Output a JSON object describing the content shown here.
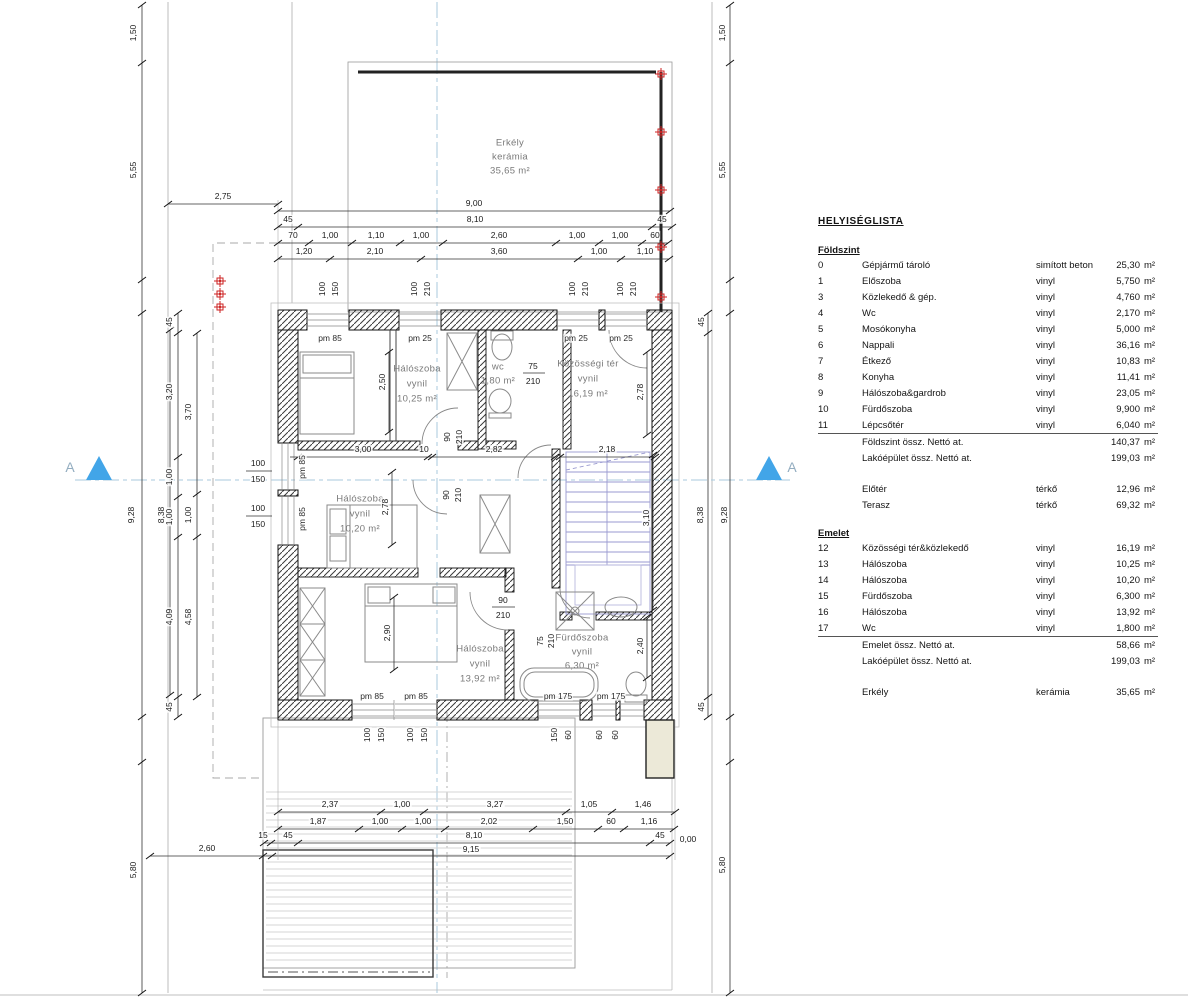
{
  "room_list": {
    "title": "HELYISÉGLISTA",
    "sections": [
      {
        "header": "Földszint",
        "rule": true,
        "rows": [
          {
            "num": "0",
            "name": "Gépjármű tároló",
            "material": "simított beton",
            "area": "25,30",
            "unit": "m²"
          },
          {
            "num": "1",
            "name": "Előszoba",
            "material": "vinyl",
            "area": "5,750",
            "unit": "m²"
          },
          {
            "num": "3",
            "name": "Közlekedő & gép.",
            "material": "vinyl",
            "area": "4,760",
            "unit": "m²"
          },
          {
            "num": "4",
            "name": "Wc",
            "material": "vinyl",
            "area": "2,170",
            "unit": "m²"
          },
          {
            "num": "5",
            "name": "Mosókonyha",
            "material": "vinyl",
            "area": "5,000",
            "unit": "m²"
          },
          {
            "num": "6",
            "name": "Nappali",
            "material": "vinyl",
            "area": "36,16",
            "unit": "m²"
          },
          {
            "num": "7",
            "name": "Étkező",
            "material": "vinyl",
            "area": "10,83",
            "unit": "m²"
          },
          {
            "num": "8",
            "name": "Konyha",
            "material": "vinyl",
            "area": "11,41",
            "unit": "m²"
          },
          {
            "num": "9",
            "name": "Hálószoba&gardrob",
            "material": "vinyl",
            "area": "23,05",
            "unit": "m²"
          },
          {
            "num": "10",
            "name": "Fürdőszoba",
            "material": "vinyl",
            "area": "9,900",
            "unit": "m²"
          },
          {
            "num": "11",
            "name": "Lépcsőtér",
            "material": "vinyl",
            "area": "6,040",
            "unit": "m²"
          }
        ],
        "totals": [
          {
            "name": "Földszint össz. Nettó at.",
            "area": "140,37",
            "unit": "m²"
          },
          {
            "name": "Lakóépület össz. Nettó at.",
            "area": "199,03",
            "unit": "m²"
          }
        ]
      },
      {
        "gap": true,
        "rows": [
          {
            "num": "",
            "name": "Előtér",
            "material": "térkő",
            "area": "12,96",
            "unit": "m²"
          },
          {
            "num": "",
            "name": "Terasz",
            "material": "térkő",
            "area": "69,32",
            "unit": "m²"
          }
        ]
      },
      {
        "header": "Emelet",
        "gap": true,
        "rule": true,
        "rows": [
          {
            "num": "12",
            "name": "Közösségi tér&közlekedő",
            "material": "vinyl",
            "area": "16,19",
            "unit": "m²"
          },
          {
            "num": "13",
            "name": "Hálószoba",
            "material": "vinyl",
            "area": "10,25",
            "unit": "m²"
          },
          {
            "num": "14",
            "name": "Hálószoba",
            "material": "vinyl",
            "area": "10,20",
            "unit": "m²"
          },
          {
            "num": "15",
            "name": "Fürdőszoba",
            "material": "vinyl",
            "area": "6,300",
            "unit": "m²"
          },
          {
            "num": "16",
            "name": "Hálószoba",
            "material": "vinyl",
            "area": "13,92",
            "unit": "m²"
          },
          {
            "num": "17",
            "name": "Wc",
            "material": "vinyl",
            "area": "1,800",
            "unit": "m²"
          }
        ],
        "totals": [
          {
            "name": "Emelet össz. Nettó at.",
            "area": "58,66",
            "unit": "m²"
          },
          {
            "name": "Lakóépület össz. Nettó at.",
            "area": "199,03",
            "unit": "m²"
          }
        ]
      },
      {
        "gap": true,
        "rows": [
          {
            "num": "",
            "name": "Erkély",
            "material": "kerámia",
            "area": "35,65",
            "unit": "m²"
          }
        ]
      }
    ]
  },
  "plan": {
    "room_texts": [
      {
        "t": "Erkély",
        "x": 510,
        "y": 143
      },
      {
        "t": "kerámia",
        "x": 510,
        "y": 157
      },
      {
        "t": "35,65 m²",
        "x": 510,
        "y": 171
      },
      {
        "t": "Hálószoba",
        "x": 417,
        "y": 369
      },
      {
        "t": "vynil",
        "x": 417,
        "y": 384
      },
      {
        "t": "10,25 m²",
        "x": 417,
        "y": 399
      },
      {
        "t": "wc",
        "x": 498,
        "y": 367
      },
      {
        "t": "1,80 m²",
        "x": 498,
        "y": 381
      },
      {
        "t": "Közösségi tér",
        "x": 588,
        "y": 364
      },
      {
        "t": "vynil",
        "x": 588,
        "y": 379
      },
      {
        "t": "16,19 m²",
        "x": 588,
        "y": 394
      },
      {
        "t": "Hálószoba",
        "x": 360,
        "y": 499
      },
      {
        "t": "vynil",
        "x": 360,
        "y": 514
      },
      {
        "t": "10,20 m²",
        "x": 360,
        "y": 529
      },
      {
        "t": "Hálószoba",
        "x": 480,
        "y": 649
      },
      {
        "t": "vynil",
        "x": 480,
        "y": 664
      },
      {
        "t": "13,92 m²",
        "x": 480,
        "y": 679
      },
      {
        "t": "Fürdőszoba",
        "x": 582,
        "y": 638
      },
      {
        "t": "vynil",
        "x": 582,
        "y": 652
      },
      {
        "t": "6,30 m²",
        "x": 582,
        "y": 666
      }
    ],
    "dims": [
      {
        "t": "2,75",
        "x": 223,
        "y": 196
      },
      {
        "t": "9,00",
        "x": 474,
        "y": 203
      },
      {
        "t": "45",
        "x": 288,
        "y": 219
      },
      {
        "t": "8,10",
        "x": 475,
        "y": 219
      },
      {
        "t": "45",
        "x": 662,
        "y": 219
      },
      {
        "t": "70",
        "x": 293,
        "y": 235
      },
      {
        "t": "1,00",
        "x": 330,
        "y": 235
      },
      {
        "t": "1,10",
        "x": 376,
        "y": 235
      },
      {
        "t": "1,00",
        "x": 421,
        "y": 235
      },
      {
        "t": "2,60",
        "x": 499,
        "y": 235
      },
      {
        "t": "1,00",
        "x": 577,
        "y": 235
      },
      {
        "t": "1,00",
        "x": 620,
        "y": 235
      },
      {
        "t": "60",
        "x": 655,
        "y": 235
      },
      {
        "t": "1,20",
        "x": 304,
        "y": 251
      },
      {
        "t": "2,10",
        "x": 375,
        "y": 251
      },
      {
        "t": "3,60",
        "x": 499,
        "y": 251
      },
      {
        "t": "1,00",
        "x": 599,
        "y": 251
      },
      {
        "t": "1,10",
        "x": 645,
        "y": 251
      },
      {
        "t": "3,00",
        "x": 363,
        "y": 449
      },
      {
        "t": "10",
        "x": 424,
        "y": 449
      },
      {
        "t": "2,82",
        "x": 494,
        "y": 449
      },
      {
        "t": "2,18",
        "x": 607,
        "y": 449
      },
      {
        "t": "2,37",
        "x": 330,
        "y": 804
      },
      {
        "t": "1,00",
        "x": 402,
        "y": 804
      },
      {
        "t": "3,27",
        "x": 495,
        "y": 804
      },
      {
        "t": "1,05",
        "x": 589,
        "y": 804
      },
      {
        "t": "1,46",
        "x": 643,
        "y": 804
      },
      {
        "t": "1,87",
        "x": 318,
        "y": 821
      },
      {
        "t": "1,00",
        "x": 380,
        "y": 821
      },
      {
        "t": "1,00",
        "x": 423,
        "y": 821
      },
      {
        "t": "2,02",
        "x": 489,
        "y": 821
      },
      {
        "t": "1,50",
        "x": 565,
        "y": 821
      },
      {
        "t": "60",
        "x": 611,
        "y": 821
      },
      {
        "t": "1,16",
        "x": 649,
        "y": 821
      },
      {
        "t": "15",
        "x": 263,
        "y": 835
      },
      {
        "t": "45",
        "x": 288,
        "y": 835
      },
      {
        "t": "8,10",
        "x": 474,
        "y": 835
      },
      {
        "t": "45",
        "x": 660,
        "y": 835
      },
      {
        "t": "0,00",
        "x": 688,
        "y": 839
      },
      {
        "t": "9,15",
        "x": 471,
        "y": 849
      },
      {
        "t": "2,60",
        "x": 207,
        "y": 848
      },
      {
        "t": "1,50",
        "x": 133,
        "y": 33,
        "r": -90
      },
      {
        "t": "5,55",
        "x": 133,
        "y": 170,
        "r": -90
      },
      {
        "t": "9,28",
        "x": 131,
        "y": 515,
        "r": -90
      },
      {
        "t": "5,80",
        "x": 133,
        "y": 870,
        "r": -90
      },
      {
        "t": "8,38",
        "x": 161,
        "y": 515,
        "r": -90
      },
      {
        "t": "45",
        "x": 169,
        "y": 322,
        "r": -90
      },
      {
        "t": "3,20",
        "x": 169,
        "y": 392,
        "r": -90
      },
      {
        "t": "1,00",
        "x": 169,
        "y": 477,
        "r": -90
      },
      {
        "t": "1,00",
        "x": 169,
        "y": 517,
        "r": -90
      },
      {
        "t": "4,09",
        "x": 169,
        "y": 617,
        "r": -90
      },
      {
        "t": "45",
        "x": 169,
        "y": 707,
        "r": -90
      },
      {
        "t": "3,70",
        "x": 188,
        "y": 412,
        "r": -90
      },
      {
        "t": "1,00",
        "x": 188,
        "y": 515,
        "r": -90
      },
      {
        "t": "4,58",
        "x": 188,
        "y": 617,
        "r": -90
      },
      {
        "t": "1,50",
        "x": 722,
        "y": 33,
        "r": -90
      },
      {
        "t": "5,55",
        "x": 722,
        "y": 170,
        "r": -90
      },
      {
        "t": "9,28",
        "x": 724,
        "y": 515,
        "r": -90
      },
      {
        "t": "5,80",
        "x": 722,
        "y": 865,
        "r": -90
      },
      {
        "t": "45",
        "x": 701,
        "y": 322,
        "r": -90
      },
      {
        "t": "8,38",
        "x": 700,
        "y": 515,
        "r": -90
      },
      {
        "t": "45",
        "x": 701,
        "y": 707,
        "r": -90
      },
      {
        "t": "2,50",
        "x": 382,
        "y": 382,
        "r": -90
      },
      {
        "t": "2,78",
        "x": 640,
        "y": 392,
        "r": -90
      },
      {
        "t": "2,78",
        "x": 385,
        "y": 507,
        "r": -90
      },
      {
        "t": "90",
        "x": 447,
        "y": 437,
        "r": -90
      },
      {
        "t": "210",
        "x": 459,
        "y": 437,
        "r": -90
      },
      {
        "t": "90",
        "x": 446,
        "y": 495,
        "r": -90
      },
      {
        "t": "210",
        "x": 458,
        "y": 495,
        "r": -90
      },
      {
        "t": "75",
        "x": 533,
        "y": 366
      },
      {
        "t": "210",
        "x": 533,
        "y": 381
      },
      {
        "t": "90",
        "x": 503,
        "y": 600
      },
      {
        "t": "210",
        "x": 503,
        "y": 615
      },
      {
        "t": "75",
        "x": 540,
        "y": 641,
        "r": -90
      },
      {
        "t": "210",
        "x": 551,
        "y": 641,
        "r": -90
      },
      {
        "t": "2,90",
        "x": 387,
        "y": 633,
        "r": -90
      },
      {
        "t": "2,40",
        "x": 640,
        "y": 646,
        "r": -90
      },
      {
        "t": "3,10",
        "x": 646,
        "y": 518,
        "r": -90
      }
    ],
    "window_sizes": [
      {
        "t": "100",
        "x": 322,
        "y": 289,
        "r": -90
      },
      {
        "t": "150",
        "x": 335,
        "y": 289,
        "r": -90
      },
      {
        "t": "100",
        "x": 414,
        "y": 289,
        "r": -90
      },
      {
        "t": "210",
        "x": 427,
        "y": 289,
        "r": -90
      },
      {
        "t": "100",
        "x": 572,
        "y": 289,
        "r": -90
      },
      {
        "t": "210",
        "x": 585,
        "y": 289,
        "r": -90
      },
      {
        "t": "100",
        "x": 620,
        "y": 289,
        "r": -90
      },
      {
        "t": "210",
        "x": 633,
        "y": 289,
        "r": -90
      },
      {
        "t": "100",
        "x": 367,
        "y": 735,
        "r": -90
      },
      {
        "t": "150",
        "x": 381,
        "y": 735,
        "r": -90
      },
      {
        "t": "100",
        "x": 410,
        "y": 735,
        "r": -90
      },
      {
        "t": "150",
        "x": 424,
        "y": 735,
        "r": -90
      },
      {
        "t": "150",
        "x": 554,
        "y": 735,
        "r": -90
      },
      {
        "t": "60",
        "x": 568,
        "y": 735,
        "r": -90
      },
      {
        "t": "60",
        "x": 599,
        "y": 735,
        "r": -90
      },
      {
        "t": "60",
        "x": 615,
        "y": 735,
        "r": -90
      },
      {
        "t": "100",
        "x": 258,
        "y": 463
      },
      {
        "t": "150",
        "x": 258,
        "y": 479
      },
      {
        "t": "100",
        "x": 258,
        "y": 508
      },
      {
        "t": "150",
        "x": 258,
        "y": 524
      }
    ],
    "parapet_labels": [
      {
        "t": "pm 85",
        "x": 330,
        "y": 338
      },
      {
        "t": "pm 25",
        "x": 420,
        "y": 338
      },
      {
        "t": "pm 25",
        "x": 576,
        "y": 338
      },
      {
        "t": "pm 25",
        "x": 621,
        "y": 338
      },
      {
        "t": "pm 85",
        "x": 302,
        "y": 467,
        "r": -90
      },
      {
        "t": "pm 85",
        "x": 302,
        "y": 519,
        "r": -90
      },
      {
        "t": "pm 85",
        "x": 372,
        "y": 696
      },
      {
        "t": "pm 85",
        "x": 416,
        "y": 696
      },
      {
        "t": "pm 175",
        "x": 558,
        "y": 696
      },
      {
        "t": "pm 175",
        "x": 611,
        "y": 696
      }
    ],
    "section_letters": [
      {
        "t": "A",
        "x": 70,
        "y": 467
      },
      {
        "t": "A",
        "x": 792,
        "y": 467
      }
    ],
    "accent_colors": {
      "section_marker": "#42a5e8",
      "survey_marker": "#cc2222",
      "stairs": "#9a9ad0",
      "centerline": "#a8cade"
    }
  }
}
